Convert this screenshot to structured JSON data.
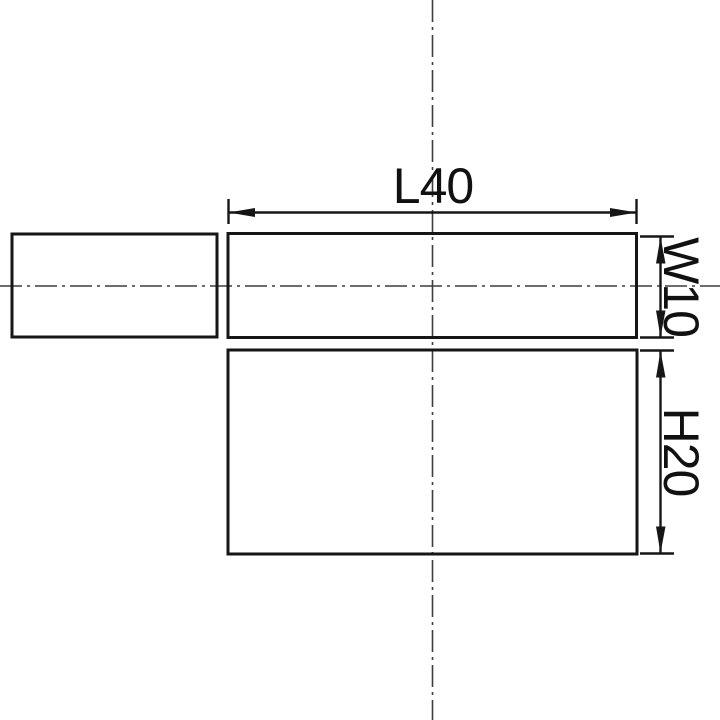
{
  "drawing": {
    "labels": {
      "length": "L40",
      "width": "W10",
      "height": "H20"
    },
    "values": {
      "length": 40,
      "width": 10,
      "height": 20
    },
    "colors": {
      "background": "#ffffff",
      "object_line": "#161616",
      "dimension_line": "#161616",
      "center_line": "#3d3d3d",
      "label_text": "#111111"
    }
  }
}
